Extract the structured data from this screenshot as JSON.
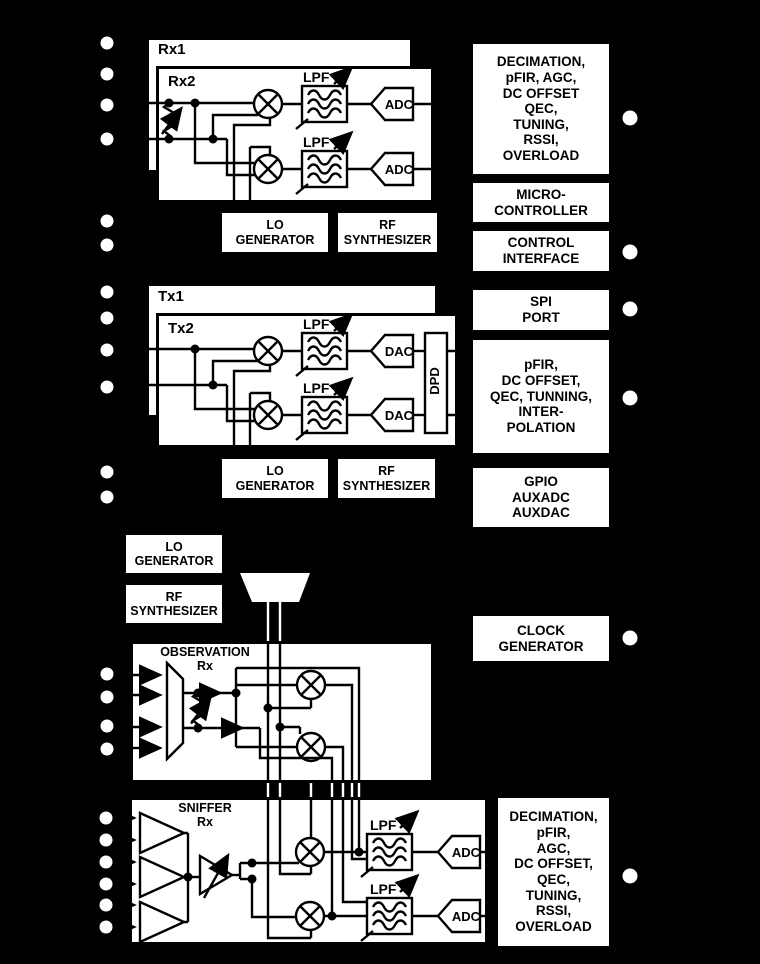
{
  "labels": {
    "rx1": "Rx1",
    "rx2": "Rx2",
    "tx1": "Tx1",
    "tx2": "Tx2",
    "lpf": "LPF",
    "adc": "ADC",
    "dac": "DAC",
    "dpd": "DPD",
    "lo_generator": "LO\nGENERATOR",
    "rf_synthesizer": "RF\nSYNTHESIZER",
    "observation_rx": "OBSERVATION\nRx",
    "sniffer_rx": "SNIFFER\nRx"
  },
  "right_column": {
    "rx_dsp": "DECIMATION,\npFIR, AGC,\nDC OFFSET\nQEC,\nTUNING,\nRSSI,\nOVERLOAD",
    "microcontroller": "MICRO-\nCONTROLLER",
    "control_interface": "CONTROL\nINTERFACE",
    "spi_port": "SPI\nPORT",
    "tx_dsp": "pFIR,\nDC OFFSET,\nQEC, TUNNING,\nINTER-\nPOLATION",
    "gpio": "GPIO\nAUXADC\nAUXDAC",
    "clock_generator": "CLOCK\nGENERATOR",
    "sniffer_dsp": "DECIMATION,\npFIR,\nAGC,\nDC OFFSET,\nQEC,\nTUNING,\nRSSI,\nOVERLOAD"
  },
  "colors": {
    "background": "#000000",
    "box_fill": "#ffffff",
    "line_inside": "#000000",
    "line_outside": "#ffffff",
    "pad": "#ffffff"
  }
}
